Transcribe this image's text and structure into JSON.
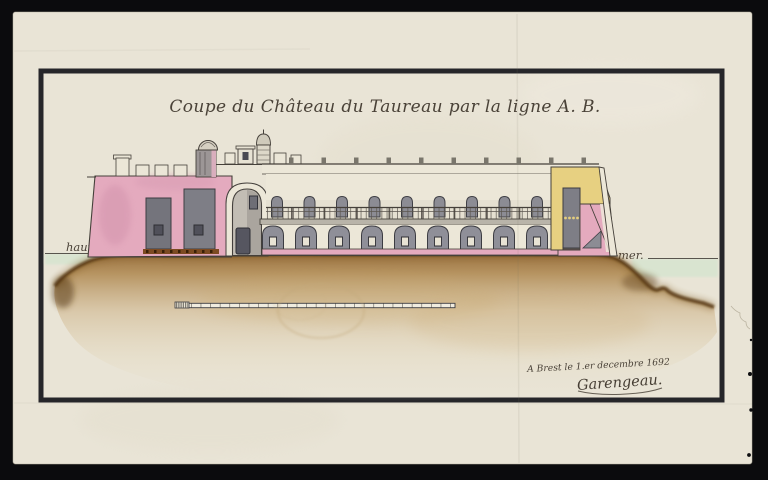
{
  "scan": {
    "title": "Coupe du Château du Taureau par la ligne A. B.",
    "water_label_left": "haute",
    "water_label_right": "mer.",
    "signature_line": "A Brest le 1.er decembre 1692",
    "signature_name": "Garengeau.",
    "colors": {
      "background": "#0b0b0d",
      "paper": "#e9e4d6",
      "frame_ink": "#26262a",
      "handwriting_ink": "#4a4238",
      "masonry_pink": "#e4aabe",
      "masonry_yellow": "#e7d081",
      "casemate_gray": "#7e7e86",
      "stone_light": "#ece7d8",
      "rock_brown": "#8a5d2a",
      "rock_edge": "#5a3a14",
      "sea_green": "#d8e5d0"
    }
  }
}
